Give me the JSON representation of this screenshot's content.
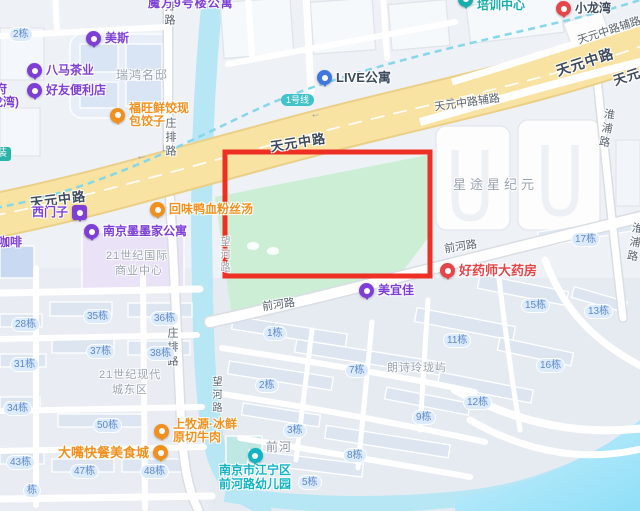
{
  "colors": {
    "purple": "#7e3fd6",
    "orange": "#f1901d",
    "red": "#e5464a",
    "teal": "#16adad",
    "cyan": "#10b5c4",
    "blue": "#3f76e0",
    "metro": "#41c4c9",
    "highlight": "#ee2f23",
    "pill_bg": "#dcebfc",
    "pill_text": "#5c88c9"
  },
  "roads": {
    "tianyuan": "天元中路",
    "tianyuan_aux": "天元中路辅路",
    "zhuangpai": "庄排路",
    "qianhe": "前河路",
    "huaipu": "淮浦路",
    "wanghe": "望河路",
    "metro": "1号线"
  },
  "areas": {
    "mofang": "魔方9号楼公寓",
    "ruihong": "瑞鸿名邸",
    "xingtu": "星途星纪元",
    "langshi": "朗诗玲珑屿",
    "qianhe_river": "前河",
    "century_intl_1": "21世纪国际",
    "century_intl_2": "商业中心",
    "century_east_1": "21世纪现代",
    "century_east_2": "城东区",
    "fu": "府",
    "longwan": "龙湾)",
    "zhuang": "装",
    "coffee": "好咖啡"
  },
  "pois": {
    "meisi": {
      "label": "美斯"
    },
    "bama": {
      "label": "八马茶业"
    },
    "haoyou": {
      "label": "好友便利店"
    },
    "fuwang": {
      "l1": "福旺鲜饺现",
      "l2": "包饺子"
    },
    "live": {
      "label": "LIVE公寓"
    },
    "peixun": {
      "l1": "盘安安全",
      "l2": "培训中心"
    },
    "xiaolongwan": {
      "label": "小龙湾"
    },
    "ximenzi": {
      "label": "西门子"
    },
    "huiwei": {
      "label": "回味鸭血粉丝汤"
    },
    "momo": {
      "label": "南京墨墨家公寓"
    },
    "haoyaoshi": {
      "label": "好药师大药房"
    },
    "meiyijia": {
      "label": "美宜佳"
    },
    "dazui": {
      "label": "大嘴快餐美食城"
    },
    "shangmuyuan": {
      "l1": "上牧源·冰鲜",
      "l2": "原切牛肉"
    },
    "youeryuan": {
      "l1": "南京市江宁区",
      "l2": "前河路幼儿园"
    }
  },
  "buildings": [
    "2栋",
    "28栋",
    "31栋",
    "34栋",
    "43栋",
    "35栋",
    "36栋",
    "37栋",
    "38栋",
    "50栋",
    "47栋",
    "48栋",
    "栋",
    "17栋",
    "13栋",
    "1栋",
    "2栋",
    "3栋",
    "5栋",
    "7栋",
    "8栋",
    "9栋",
    "11栋",
    "12栋",
    "15栋",
    "16栋"
  ],
  "arrows": {
    "left": "←",
    "right": "→",
    "down": "↓"
  }
}
